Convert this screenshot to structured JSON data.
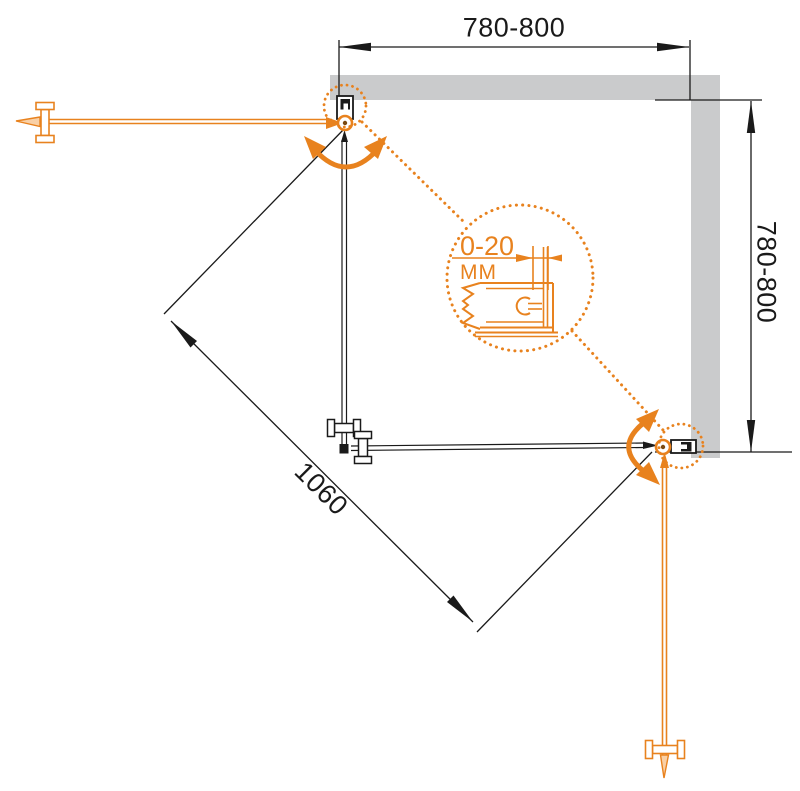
{
  "drawing": {
    "kind": "shower-enclosure-installation-diagram",
    "dimensions": {
      "top_width_label": "780-800",
      "right_height_label": "780-800",
      "diagonal_entry_label": "1060"
    },
    "detail_callout": {
      "range_label": "0-20",
      "unit_label": "ММ"
    }
  },
  "colors": {
    "accent": "#E8821E",
    "accent-light": "#F9D0A6",
    "wall": "#CACBCC",
    "line": "#1A1A1A"
  }
}
